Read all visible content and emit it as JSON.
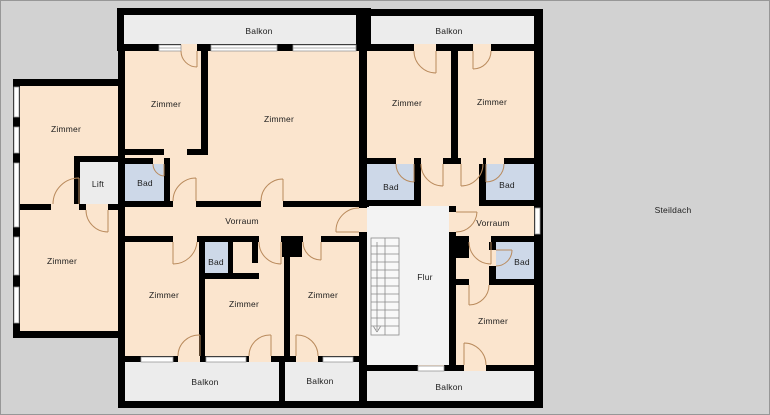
{
  "plan": {
    "title_note": "Steildach",
    "summary": {
      "zimmer_count": 10,
      "bad_count": 5,
      "balkon_count": 5,
      "vorraum_count": 2,
      "lift_count": 1,
      "flur_count": 1
    },
    "colors": {
      "room": "#fbe5ce",
      "bath": "#cdd8e8",
      "balcony": "#ececec",
      "hall": "#f3f3f3",
      "wall": "#000000",
      "background": "#d2d2d2",
      "door_arc": "#b98a5c",
      "window": "#ffffff",
      "text": "#1d1d1d"
    },
    "labels": [
      {
        "text": "Balkon",
        "kind": "balcony",
        "x": 258,
        "y": 30
      },
      {
        "text": "Balkon",
        "kind": "balcony",
        "x": 448,
        "y": 30
      },
      {
        "text": "Zimmer",
        "kind": "room",
        "x": 65,
        "y": 128
      },
      {
        "text": "Zimmer",
        "kind": "room",
        "x": 165,
        "y": 103
      },
      {
        "text": "Zimmer",
        "kind": "room",
        "x": 278,
        "y": 118
      },
      {
        "text": "Zimmer",
        "kind": "room",
        "x": 406,
        "y": 102
      },
      {
        "text": "Zimmer",
        "kind": "room",
        "x": 491,
        "y": 101
      },
      {
        "text": "Lift",
        "kind": "lift",
        "x": 97,
        "y": 183
      },
      {
        "text": "Bad",
        "kind": "bath",
        "x": 144,
        "y": 182
      },
      {
        "text": "Bad",
        "kind": "bath",
        "x": 390,
        "y": 186
      },
      {
        "text": "Bad",
        "kind": "bath",
        "x": 506,
        "y": 184
      },
      {
        "text": "Vorraum",
        "kind": "hall",
        "x": 241,
        "y": 220
      },
      {
        "text": "Vorraum",
        "kind": "hall",
        "x": 492,
        "y": 222
      },
      {
        "text": "Steildach",
        "kind": "roof",
        "x": 672,
        "y": 209
      },
      {
        "text": "Zimmer",
        "kind": "room",
        "x": 61,
        "y": 260
      },
      {
        "text": "Bad",
        "kind": "bath",
        "x": 215,
        "y": 261
      },
      {
        "text": "Bad",
        "kind": "bath",
        "x": 521,
        "y": 261
      },
      {
        "text": "Zimmer",
        "kind": "room",
        "x": 163,
        "y": 294
      },
      {
        "text": "Zimmer",
        "kind": "room",
        "x": 243,
        "y": 303
      },
      {
        "text": "Zimmer",
        "kind": "room",
        "x": 322,
        "y": 294
      },
      {
        "text": "Flur",
        "kind": "hall",
        "x": 424,
        "y": 276
      },
      {
        "text": "Zimmer",
        "kind": "room",
        "x": 492,
        "y": 320
      },
      {
        "text": "Balkon",
        "kind": "balcony",
        "x": 204,
        "y": 381
      },
      {
        "text": "Balkon",
        "kind": "balcony",
        "x": 319,
        "y": 380
      },
      {
        "text": "Balkon",
        "kind": "balcony",
        "x": 448,
        "y": 386
      }
    ]
  }
}
